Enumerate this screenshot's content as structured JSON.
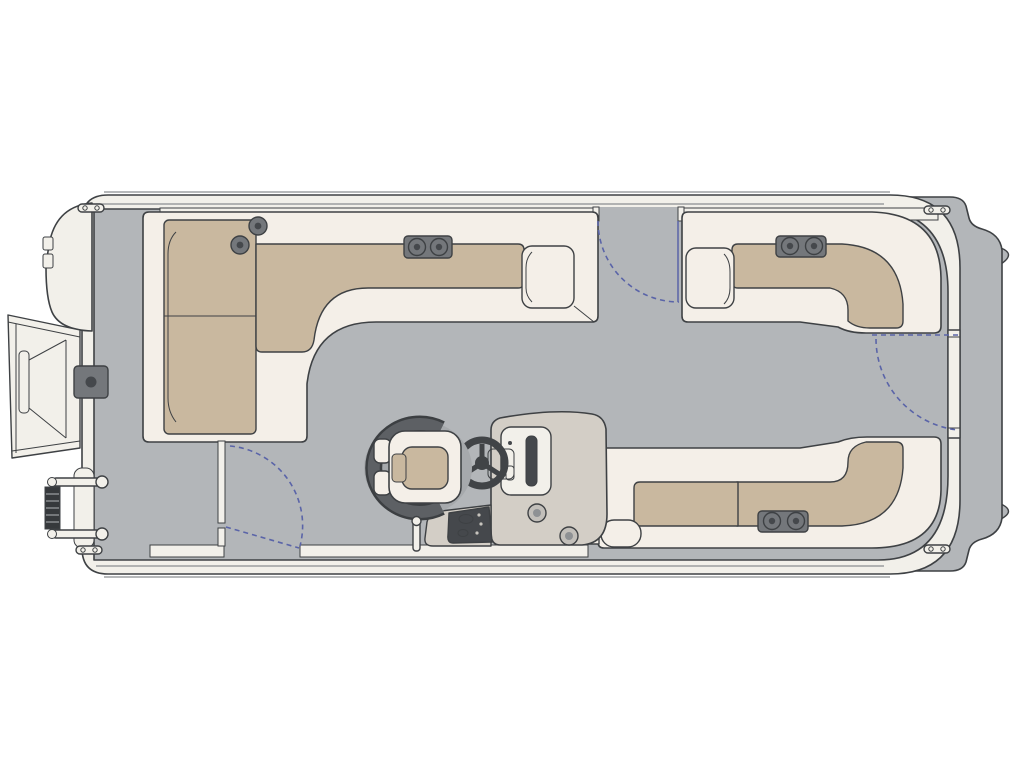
{
  "colors": {
    "page": "#ffffff",
    "deck": "#b3b6b9",
    "trim": "#f2f0ea",
    "upholstery": "#f4efe8",
    "cushion": "#c9b89f",
    "console": "#d3cec6",
    "hardware": "#74777b",
    "hardware_dark": "#45484c",
    "chair_dark": "#5d6064",
    "ladder_dark": "#36393c",
    "outline": "#3e4144",
    "outline_soft": "#8a8d90",
    "gate": "#5a64a8"
  },
  "diagram": {
    "type": "floor-plan",
    "subject": "pontoon-boat-top-view",
    "features": {
      "lounges": 3,
      "gates": 3,
      "cleats": 4,
      "cup_holders": 10,
      "ladders": 1
    }
  },
  "components": {
    "hull": "Pontoon hull and rail",
    "stern_cap": "Stern cap",
    "bow_cap": "Bow nose cap",
    "gangway": "Bow boarding gangway",
    "ladder": "Boarding ladder",
    "bow_fitting": "Bow deck latch fitting",
    "cleat": "Mooring cleat",
    "bow_lounge": "Bow L-shaped lounge",
    "rear_port_lounge": "Rear port L-lounge",
    "rear_starboard_lounge": "Rear starboard L-lounge",
    "helm_console": "Helm console",
    "steering_wheel": "Steering wheel",
    "captain_chair": "Captain's chair",
    "seatback": "Companion seat back",
    "ski_pylon": "Ski pylon",
    "cup_holder": "Cup holder",
    "cup_holder_pod": "Dual cup holder pod",
    "port_gate": "Port side gate swing",
    "starboard_gate": "Starboard bow gate swing",
    "stern_gate": "Stern gate swing"
  }
}
